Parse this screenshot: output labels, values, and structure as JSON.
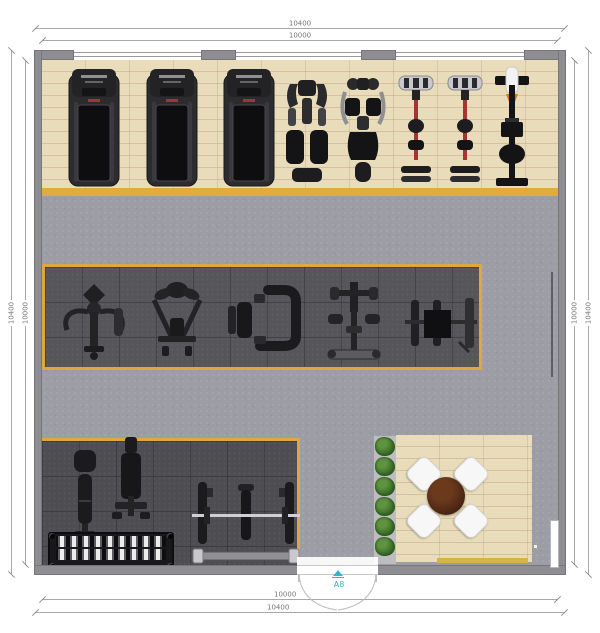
{
  "plan": {
    "type": "gym-floor-plan",
    "room_shape": "rectangular",
    "door_wall": "bottom"
  },
  "dims": {
    "top_outer": "10400",
    "top_inner": "10000",
    "bottom_inner": "10000",
    "bottom_outer": "10400",
    "left_outer": "10400",
    "left_inner": "10000",
    "right_inner": "10000",
    "right_outer": "10400"
  },
  "door": {
    "label": "A8",
    "color": "#35b6c6"
  },
  "equipment": {
    "cardio_row": [
      "treadmill",
      "treadmill",
      "treadmill",
      "cross-trainer",
      "recumbent-bike",
      "spin-bike",
      "spin-bike",
      "rowing-machine"
    ],
    "strength_row": [
      "pec-deck-machine",
      "lat-pulldown-machine",
      "leg-press-machine",
      "multi-press-station",
      "bench-station"
    ],
    "free_weight_area": [
      "flat-bench",
      "adjustable-bench",
      "dumbbell-rack",
      "bench-press-rack"
    ],
    "lounge": [
      "round-table",
      "chair",
      "chair",
      "chair",
      "chair",
      "plant-row"
    ]
  },
  "colors": {
    "wall": "#8d8d92",
    "concrete_floor": "#9d9da5",
    "wood_floor": "#e9dcba",
    "rubber_mat": "#55555a",
    "accent_border": "#e2ab3e",
    "door_label": "#35b6c6",
    "table": "#4a2413",
    "plants": "#3c7029"
  }
}
